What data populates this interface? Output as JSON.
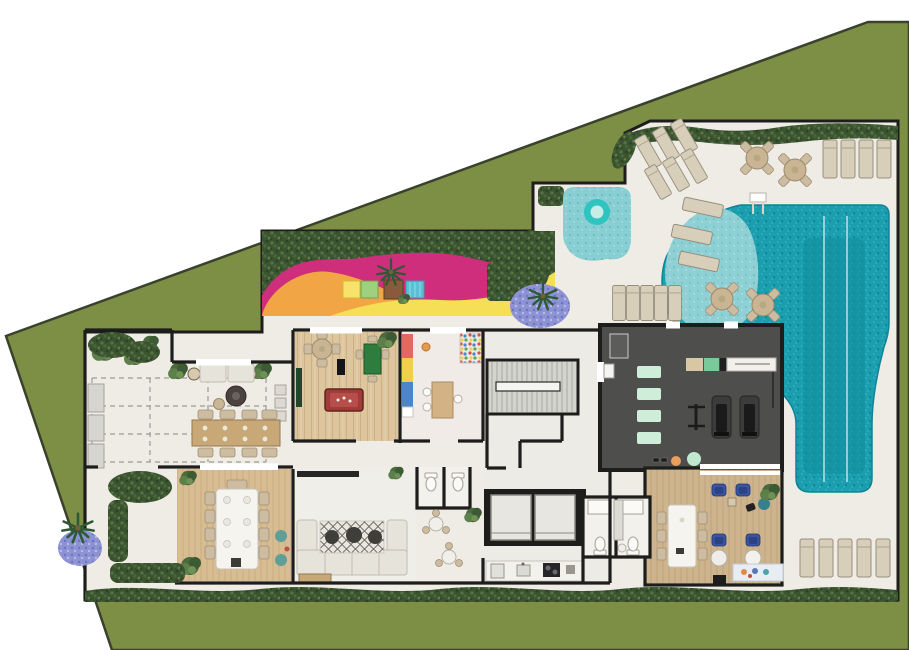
{
  "scene": {
    "kind": "residential-floor-plan",
    "view": "top-down-color-render",
    "lot_shape": "irregular-pentagon",
    "canvas": {
      "width": 909,
      "height": 650
    },
    "visible_text": "none"
  },
  "colors": {
    "background": "#ffffff",
    "lawn": "#7d8f44",
    "lawn-stroke": "#3a412d",
    "deck": "#efece6",
    "wall": "#1d1d1b",
    "hedge": "#3b5330",
    "pool": "#1b9fae",
    "pool-deep": "#118a9c",
    "pool-shelf": "#8fd0d4",
    "kids-ring": "#2fc4bf",
    "pg-pink": "#ce2e7c",
    "pg-orange": "#f2a544",
    "pg-yellow": "#f4df55",
    "wood": "#ddc59e",
    "wood-dining": "#d8bd93",
    "wood-spa": "#cdb48e",
    "gym-floor": "#4e4e4c",
    "mat-mint": "#cfeeda",
    "sofa": "#e6e3da",
    "lounger": "#d8cfbb",
    "blue-chair": "#3b55a1",
    "lavender": "#8d92d3",
    "billiard-red": "#a03b38",
    "card-green": "#2e7d3f",
    "shelf-red": "#e2695f",
    "shelf-yellow": "#efcf4c",
    "shelf-blue": "#4b86c6",
    "pouf-teal": "#5f9f96"
  },
  "areas": [
    {
      "id": "lawn",
      "kind": "grass"
    },
    {
      "id": "pool-deck",
      "kind": "paved-deck"
    },
    {
      "id": "playground",
      "kind": "outdoor-play-area",
      "features": [
        "hedge",
        "rubber-floor-pink",
        "rubber-floor-orange",
        "rubber-floor-yellow",
        "play-cubes",
        "palm-tree"
      ]
    },
    {
      "id": "kids-pool",
      "kind": "pool",
      "features": [
        "splash-ring"
      ]
    },
    {
      "id": "main-pool",
      "kind": "lap-pool",
      "features": [
        "wet-deck",
        "in-water-loungers",
        "lane-lines",
        "ladder"
      ]
    },
    {
      "id": "sun-deck",
      "kind": "deck",
      "features": [
        "sun-loungers",
        "bistro-tables"
      ]
    },
    {
      "id": "garden-bed",
      "kind": "planting",
      "features": [
        "ferns",
        "lavender",
        "palm"
      ]
    },
    {
      "id": "gourmet-terrace",
      "kind": "room",
      "features": [
        "sofa-row",
        "fire-pit",
        "dining-table-8",
        "side-tables",
        "planters",
        "flex-dashed-area",
        "service-counters"
      ]
    },
    {
      "id": "games-room",
      "kind": "room",
      "features": [
        "billiard-table",
        "card-table",
        "round-table",
        "tv",
        "sideboard",
        "plant"
      ]
    },
    {
      "id": "kids-playroom",
      "kind": "room",
      "features": [
        "color-shelf",
        "ball-pit",
        "craft-table",
        "stool"
      ]
    },
    {
      "id": "stair-core",
      "kind": "circulation",
      "features": [
        "stairs",
        "landing"
      ]
    },
    {
      "id": "elevator-bank",
      "kind": "circulation",
      "features": [
        "elevator",
        "elevator"
      ]
    },
    {
      "id": "restrooms",
      "kind": "wc",
      "features": [
        "toilet",
        "shower"
      ]
    },
    {
      "id": "kitchenette",
      "kind": "service",
      "features": [
        "counter",
        "fridge",
        "sink",
        "cooktop"
      ]
    },
    {
      "id": "dining-room",
      "kind": "room",
      "features": [
        "table-10-seats",
        "plants"
      ]
    },
    {
      "id": "lounge",
      "kind": "room",
      "features": [
        "u-sofa",
        "rug",
        "poufs",
        "tv-console",
        "bench"
      ]
    },
    {
      "id": "gym",
      "kind": "room",
      "features": [
        "exercise-mats",
        "treadmill",
        "treadmill",
        "equipment-shelf",
        "barbell-rack",
        "exercise-balls",
        "dumbbells",
        "locker"
      ]
    },
    {
      "id": "coworking-room",
      "kind": "room",
      "features": [
        "long-table",
        "blue-armchairs",
        "round-side-tables",
        "colorful-rug",
        "plant"
      ]
    },
    {
      "id": "patio",
      "kind": "courtyard",
      "features": [
        "shrubs",
        "lavender",
        "palm"
      ]
    }
  ],
  "counts": {
    "sun_loungers_top_diagonal": 6,
    "sun_loungers_top_right": 4,
    "sun_loungers_mid_deck": 5,
    "sun_loungers_bottom_right": 5,
    "in_pool_loungers": 3,
    "bistro_tables": 4,
    "play_cubes": 4,
    "exercise_mats": 4,
    "elevators": 2
  }
}
